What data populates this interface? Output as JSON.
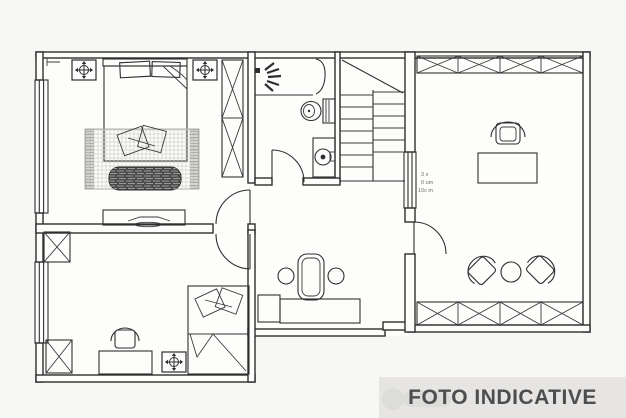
{
  "banner": {
    "label": "FOTO INDICATIVE"
  },
  "plan": {
    "annotation_lines": [
      "3 x",
      "0 um",
      "10c m"
    ],
    "rooms": [
      {
        "name": "master-bedroom",
        "position": "top-left"
      },
      {
        "name": "bathroom",
        "position": "top-middle"
      },
      {
        "name": "staircase",
        "position": "middle"
      },
      {
        "name": "office-study",
        "position": "right"
      },
      {
        "name": "second-bedroom",
        "position": "bottom-left"
      },
      {
        "name": "hallway",
        "position": "bottom-middle"
      }
    ],
    "furniture_icons": [
      "double-bed-icon",
      "pillow-icon",
      "rug-icon",
      "bench-icon",
      "dresser-icon",
      "wardrobe-x-icon",
      "ceiling-light-icon",
      "shower-spray-icon",
      "shower-screen-icon",
      "toilet-icon",
      "sink-icon",
      "stairs-icon",
      "desk-icon",
      "office-chair-icon",
      "single-bed-icon",
      "armchair-icon",
      "round-table-icon",
      "stool-icon",
      "door-swing-icon",
      "window-icon"
    ]
  },
  "colors": {
    "line": "#2d2d2d",
    "background": "#f7f7f5",
    "plan_fill": "#fdfdfc",
    "banner_background": "#e6e5e3",
    "banner_text": "#4d4d4d",
    "bench_fill": "#4c4c4c",
    "rug_tone": "#c9c9c3"
  }
}
